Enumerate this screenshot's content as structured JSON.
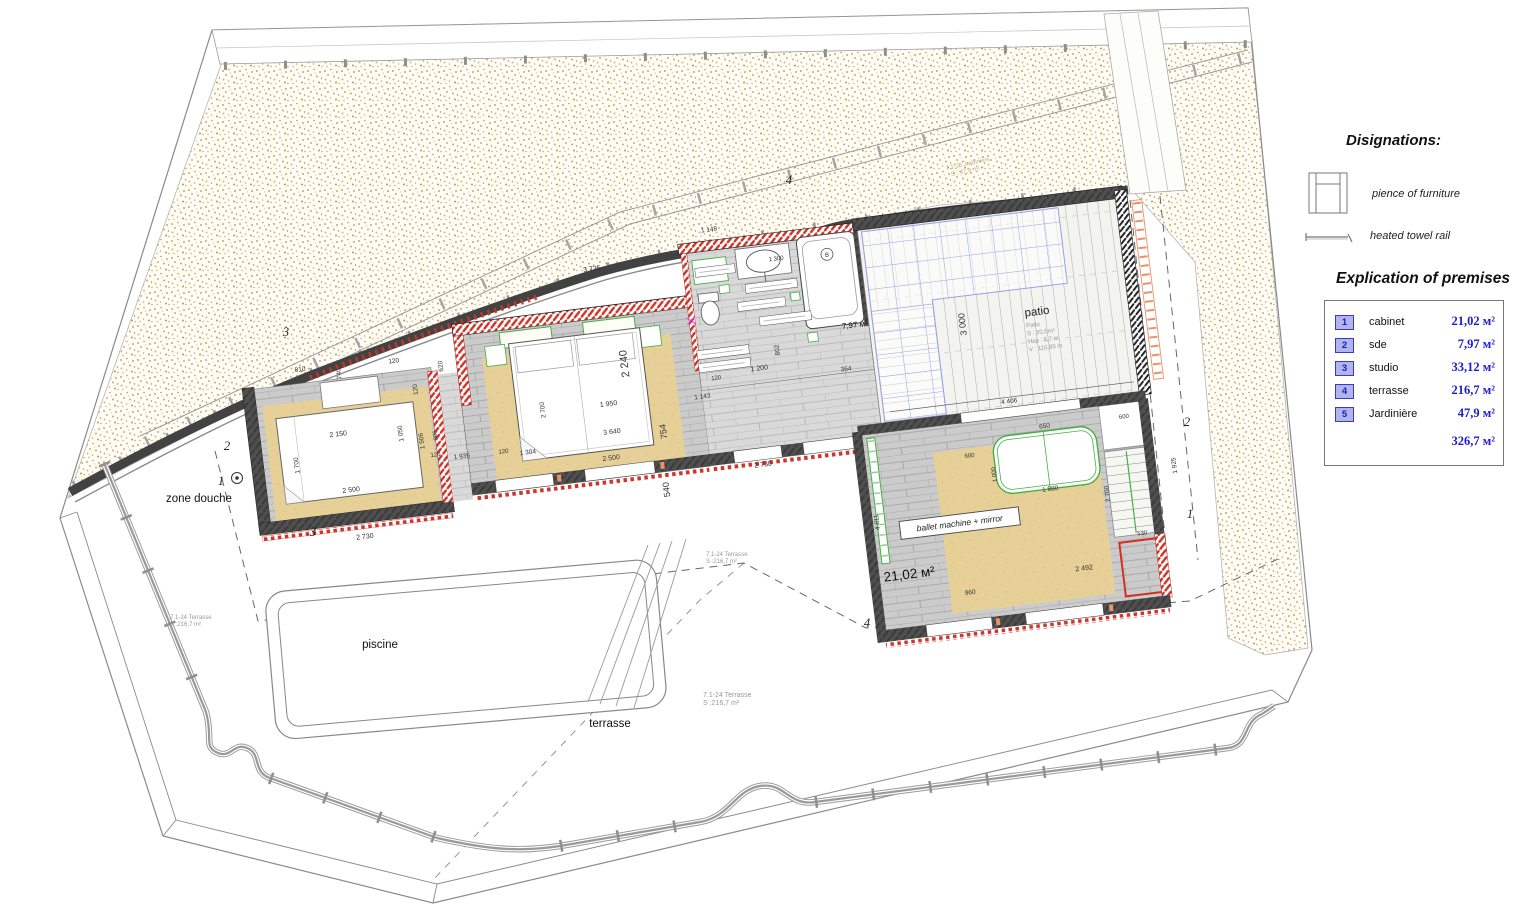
{
  "legend": {
    "designations_title": "Disignations:",
    "furniture_label": "pience of furniture",
    "towel_label": "heated towel rail",
    "explication_title": "Explication of premises",
    "accent_color": "#1b1bcd",
    "rows": [
      {
        "num": "1",
        "name": "cabinet",
        "area": "21,02 м²"
      },
      {
        "num": "2",
        "name": "sde",
        "area": "7,97 м²"
      },
      {
        "num": "3",
        "name": "studio",
        "area": "33,12 м²"
      },
      {
        "num": "4",
        "name": "terrasse",
        "area": "216,7 м²"
      },
      {
        "num": "5",
        "name": "Jardinière",
        "area": "47,9 м²"
      }
    ],
    "total_area": "326,7 м²"
  },
  "plan": {
    "labels": {
      "zone_douche": "zone douche",
      "piscine": "piscine",
      "terrasse": "terrasse",
      "cabinet_area": "21,02 м²",
      "sde_area": "7,97 м²",
      "ballet": "ballet machine + mirror",
      "bath_marker": "B"
    },
    "patio": {
      "title": "patio",
      "details": [
        "Patio",
        "S : 20,5m²",
        "Hsp : 5,7 m",
        "V : 116,85 m"
      ]
    },
    "terrasse_note": {
      "l1": "7.1-24 Terrasse",
      "l2": "S :216,7 m²"
    },
    "terrasse_note_positions": [
      {
        "x": 170,
        "y": 619,
        "s": 6
      },
      {
        "x": 706,
        "y": 556,
        "s": 6
      },
      {
        "x": 703,
        "y": 697,
        "s": 7
      }
    ],
    "jardiniere_note": {
      "l1": "7.1-25 Jardinière",
      "l2": "S : 47,9 m²"
    },
    "markers": [
      {
        "t": "3",
        "x": 286,
        "y": 336
      },
      {
        "t": "2",
        "x": 227,
        "y": 450
      },
      {
        "t": "1",
        "x": 221,
        "y": 485
      },
      {
        "t": "4",
        "x": 789,
        "y": 184
      },
      {
        "t": "3",
        "x": 313,
        "y": 536
      },
      {
        "t": "4",
        "x": 867,
        "y": 627
      },
      {
        "t": "2",
        "x": 1187,
        "y": 426
      },
      {
        "t": "1",
        "x": 1190,
        "y": 518
      }
    ],
    "dimensions": [
      {
        "v": "810",
        "x": 310,
        "y": 320
      },
      {
        "v": "740",
        "x": 350,
        "y": 327,
        "r": -90
      },
      {
        "v": "120",
        "x": 404,
        "y": 323
      },
      {
        "v": "2 150",
        "x": 340,
        "y": 389,
        "s": 7
      },
      {
        "v": "1 050",
        "x": 404,
        "y": 394,
        "r": -90
      },
      {
        "v": "1 700",
        "x": 297,
        "y": 413,
        "r": -90
      },
      {
        "v": "2 500",
        "x": 346,
        "y": 446,
        "s": 7
      },
      {
        "v": "120",
        "x": 424,
        "y": 352,
        "r": -90
      },
      {
        "v": "1 906",
        "x": 424,
        "y": 404,
        "r": -90
      },
      {
        "v": "906",
        "x": 438,
        "y": 400,
        "r": -90,
        "s": 6
      },
      {
        "v": "2 730",
        "x": 354,
        "y": 494,
        "s": 7
      },
      {
        "v": "1 935",
        "x": 460,
        "y": 426
      },
      {
        "v": "120",
        "x": 434,
        "y": 421,
        "s": 6
      },
      {
        "v": "620",
        "x": 452,
        "y": 332,
        "r": -90
      },
      {
        "v": "3 735",
        "x": 612,
        "y": 256,
        "s": 7
      },
      {
        "v": "2 240",
        "x": 636,
        "y": 352,
        "r": -90,
        "s": 11
      },
      {
        "v": "2 700",
        "x": 548,
        "y": 388,
        "r": -90
      },
      {
        "v": "1 304",
        "x": 526,
        "y": 430
      },
      {
        "v": "120",
        "x": 502,
        "y": 426,
        "s": 6
      },
      {
        "v": "1 950",
        "x": 612,
        "y": 392,
        "s": 7
      },
      {
        "v": "3 640",
        "x": 612,
        "y": 420,
        "s": 7
      },
      {
        "v": "2 500",
        "x": 608,
        "y": 446,
        "s": 7
      },
      {
        "v": "754",
        "x": 666,
        "y": 424,
        "r": -90,
        "s": 9
      },
      {
        "v": "540",
        "x": 662,
        "y": 482,
        "r": -90,
        "s": 9
      },
      {
        "v": "1 143",
        "x": 706,
        "y": 396
      },
      {
        "v": "1 148",
        "x": 733,
        "y": 231
      },
      {
        "v": "1 300",
        "x": 796,
        "y": 268,
        "s": 6
      },
      {
        "v": "120",
        "x": 722,
        "y": 379,
        "s": 6
      },
      {
        "v": "1 200",
        "x": 766,
        "y": 375,
        "s": 7
      },
      {
        "v": "364",
        "x": 852,
        "y": 386
      },
      {
        "v": "802",
        "x": 788,
        "y": 357,
        "r": -90
      },
      {
        "v": "3 000",
        "x": 976,
        "y": 354,
        "r": -90,
        "s": 9
      },
      {
        "v": "4 406",
        "x": 1010,
        "y": 438
      },
      {
        "v": "2 730",
        "x": 758,
        "y": 471,
        "s": 7
      },
      {
        "v": "650",
        "x": 1042,
        "y": 467
      },
      {
        "v": "600",
        "x": 964,
        "y": 487,
        "s": 6
      },
      {
        "v": "600",
        "x": 1122,
        "y": 467,
        "s": 6
      },
      {
        "v": "1 000",
        "x": 988,
        "y": 507,
        "r": -90,
        "s": 6
      },
      {
        "v": "1 880",
        "x": 1040,
        "y": 530
      },
      {
        "v": "2 700",
        "x": 1098,
        "y": 540,
        "r": -90
      },
      {
        "v": "2 492",
        "x": 1064,
        "y": 613,
        "s": 7
      },
      {
        "v": "960",
        "x": 948,
        "y": 623
      },
      {
        "v": "4 611",
        "x": 866,
        "y": 540,
        "r": -90
      },
      {
        "v": "530",
        "x": 1126,
        "y": 585,
        "s": 6
      },
      {
        "v": "1 925",
        "x": 1168,
        "y": 520,
        "r": -90
      }
    ]
  }
}
